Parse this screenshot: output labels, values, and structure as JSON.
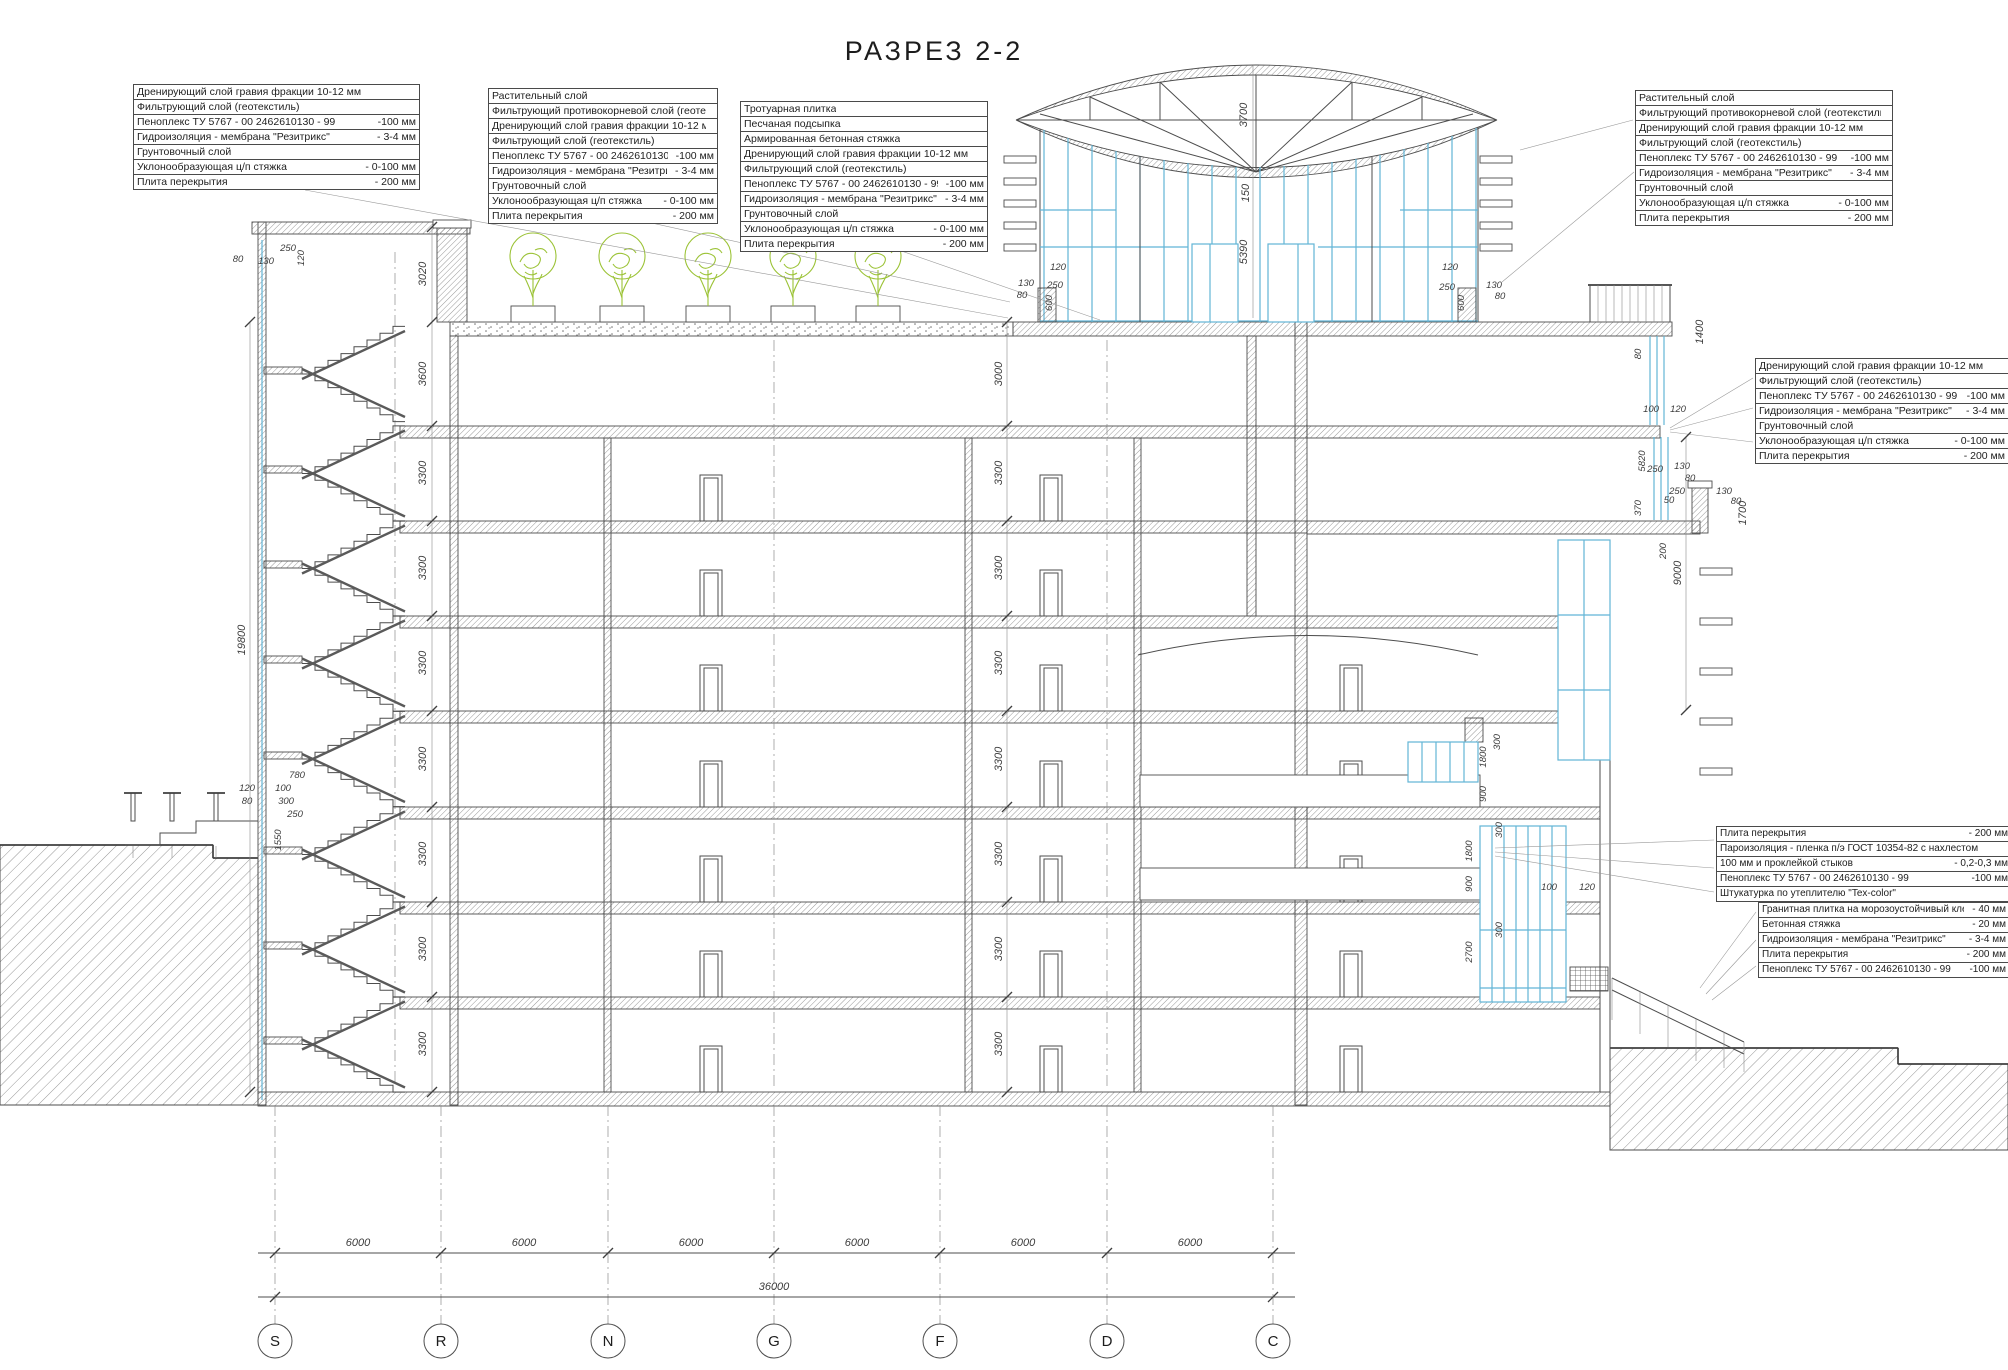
{
  "title": "РАЗРЕЗ  2-2",
  "colors": {
    "glazing_accent": "#62b5d6",
    "vegetation_accent": "#9cc337",
    "line": "#4d4d4d"
  },
  "tables": {
    "t1": {
      "rows": [
        {
          "l": "Дренирующий слой гравия фракции 10-12 мм",
          "v": ""
        },
        {
          "l": "Фильтрующий слой (геотекстиль)",
          "v": ""
        },
        {
          "l": "Пеноплекс ТУ 5767 - 00  2462610130 - 99",
          "v": "-100 мм"
        },
        {
          "l": "Гидроизоляция - мембрана \"Резитрикс\"",
          "v": "- 3-4 мм"
        },
        {
          "l": "Грунтовочный слой",
          "v": ""
        },
        {
          "l": "Уклонообразующая ц/п стяжка",
          "v": "- 0-100 мм"
        },
        {
          "l": "Плита перекрытия",
          "v": "- 200 мм"
        }
      ]
    },
    "t2": {
      "rows": [
        {
          "l": "Растительный слой",
          "v": ""
        },
        {
          "l": "Фильтрующий противокорневой слой (геотекстиль)",
          "v": ""
        },
        {
          "l": "Дренирующий слой гравия фракции 10-12 мм",
          "v": ""
        },
        {
          "l": "Фильтрующий слой (геотекстиль)",
          "v": ""
        },
        {
          "l": "Пеноплекс ТУ 5767 - 00  2462610130 - 99",
          "v": "-100 мм"
        },
        {
          "l": "Гидроизоляция - мембрана \"Резитрикс\"",
          "v": "- 3-4 мм"
        },
        {
          "l": "Грунтовочный слой",
          "v": ""
        },
        {
          "l": "Уклонообразующая ц/п стяжка",
          "v": "- 0-100 мм"
        },
        {
          "l": "Плита перекрытия",
          "v": "- 200 мм"
        }
      ]
    },
    "t3": {
      "rows": [
        {
          "l": "Тротуарная плитка",
          "v": ""
        },
        {
          "l": "Песчаная подсыпка",
          "v": ""
        },
        {
          "l": "Армированная бетонная стяжка",
          "v": ""
        },
        {
          "l": "Дренирующий слой гравия фракции 10-12 мм",
          "v": ""
        },
        {
          "l": "Фильтрующий слой (геотекстиль)",
          "v": ""
        },
        {
          "l": "Пеноплекс ТУ 5767 - 00  2462610130 - 99",
          "v": "-100 мм"
        },
        {
          "l": "Гидроизоляция - мембрана \"Резитрикс\"",
          "v": "- 3-4 мм"
        },
        {
          "l": "Грунтовочный слой",
          "v": ""
        },
        {
          "l": "Уклонообразующая ц/п стяжка",
          "v": "- 0-100 мм"
        },
        {
          "l": "Плита перекрытия",
          "v": "- 200 мм"
        }
      ]
    },
    "t4": {
      "rows": [
        {
          "l": "Растительный слой",
          "v": ""
        },
        {
          "l": "Фильтрующий противокорневой слой (геотекстиль)",
          "v": ""
        },
        {
          "l": "Дренирующий слой гравия фракции 10-12 мм",
          "v": ""
        },
        {
          "l": "Фильтрующий слой (геотекстиль)",
          "v": ""
        },
        {
          "l": "Пеноплекс ТУ 5767 - 00  2462610130 - 99",
          "v": "-100 мм"
        },
        {
          "l": "Гидроизоляция - мембрана \"Резитрикс\"",
          "v": "- 3-4 мм"
        },
        {
          "l": "Грунтовочный слой",
          "v": ""
        },
        {
          "l": "Уклонообразующая ц/п стяжка",
          "v": "- 0-100 мм"
        },
        {
          "l": "Плита перекрытия",
          "v": "- 200 мм"
        }
      ]
    },
    "t5": {
      "rows": [
        {
          "l": "Дренирующий слой гравия фракции 10-12 мм",
          "v": ""
        },
        {
          "l": "Фильтрующий слой (геотекстиль)",
          "v": ""
        },
        {
          "l": "Пеноплекс ТУ 5767 - 00  2462610130 - 99",
          "v": "-100 мм"
        },
        {
          "l": "Гидроизоляция - мембрана \"Резитрикс\"",
          "v": "- 3-4 мм"
        },
        {
          "l": "Грунтовочный слой",
          "v": ""
        },
        {
          "l": "Уклонообразующая ц/п стяжка",
          "v": "- 0-100 мм"
        },
        {
          "l": "Плита перекрытия",
          "v": "- 200 мм"
        }
      ]
    },
    "t6": {
      "rows": [
        {
          "l": "Плита перекрытия",
          "v": "- 200 мм"
        },
        {
          "l": "Пароизоляция - пленка п/э ГОСТ 10354-82  с нахлестом",
          "v": ""
        },
        {
          "l": "100 мм и проклейкой стыков",
          "v": "- 0,2-0,3 мм"
        },
        {
          "l": "Пеноплекс ТУ 5767 - 00  2462610130 - 99",
          "v": "-100 мм"
        },
        {
          "l": "Штукатурка по утеплителю \"Tex-color\"",
          "v": ""
        }
      ]
    },
    "t7": {
      "rows": [
        {
          "l": "Гранитная плитка на морозоустойчивый клей",
          "v": "- 40 мм"
        },
        {
          "l": "Бетонная стяжка",
          "v": "- 20 мм"
        },
        {
          "l": "Гидроизоляция - мембрана \"Резитрикс\"",
          "v": "- 3-4 мм"
        },
        {
          "l": "Плита перекрытия",
          "v": "- 200 мм"
        },
        {
          "l": "Пеноплекс ТУ 5767 - 00  2462610130 - 99",
          "v": "-100 мм"
        }
      ]
    }
  },
  "dims": {
    "left_chain": [
      "3020",
      "3600",
      "3300",
      "3300",
      "3300",
      "3300",
      "3300",
      "3300",
      "3300"
    ],
    "left_total": "19800",
    "center_chain": [
      "3000",
      "3300",
      "3300",
      "3300",
      "3300",
      "3300",
      "3300",
      "3300"
    ],
    "top_left": [
      "80",
      "130",
      "250",
      "120"
    ],
    "entry": [
      "780",
      "120",
      "100",
      "80",
      "300",
      "250",
      "1550"
    ],
    "dome": [
      "3700",
      "150",
      "5390",
      "600",
      "600",
      "120",
      "250",
      "130",
      "80",
      "120",
      "250",
      "130",
      "80"
    ],
    "right_upper": [
      "1400",
      "80",
      "100",
      "120",
      "5820",
      "250",
      "130",
      "80",
      "250",
      "50",
      "130",
      "80",
      "1700",
      "370",
      "200",
      "9000"
    ],
    "right_mid": [
      "300",
      "1800",
      "900",
      "300",
      "1800",
      "900",
      "100",
      "120",
      "300",
      "2700"
    ],
    "bottom_bays": [
      "6000",
      "6000",
      "6000",
      "6000",
      "6000",
      "6000"
    ],
    "bottom_total": "36000",
    "axes": [
      "S",
      "R",
      "N",
      "G",
      "F",
      "D",
      "C"
    ]
  }
}
